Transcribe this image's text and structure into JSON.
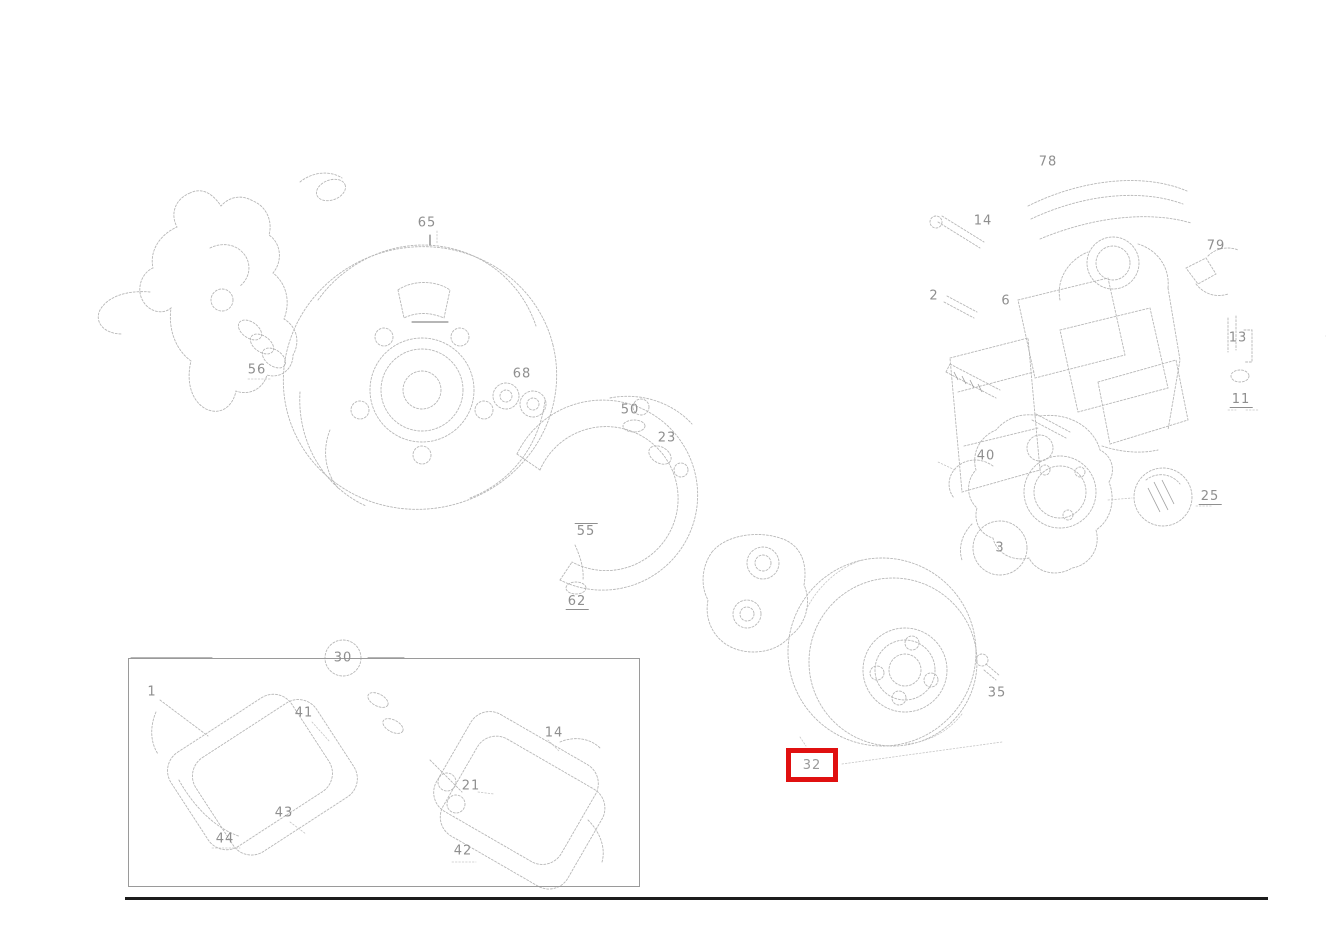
{
  "page": {
    "background": "#ffffff",
    "kind": "exploded-parts-diagram",
    "subject": "brake and wheel hub assembly parts drawing"
  },
  "diagram": {
    "stroke_color": "#b7b7b7",
    "label_color": "#8f8f8f",
    "labels": [
      {
        "id": "label-65",
        "text": "65",
        "x": 427,
        "y": 223
      },
      {
        "id": "label-56",
        "text": "56",
        "x": 257,
        "y": 370
      },
      {
        "id": "label-68",
        "text": "68",
        "x": 522,
        "y": 374
      },
      {
        "id": "label-50",
        "text": "50",
        "x": 630,
        "y": 410
      },
      {
        "id": "label-23",
        "text": "23",
        "x": 667,
        "y": 438
      },
      {
        "id": "label-55",
        "text": "55",
        "x": 586,
        "y": 531,
        "overline": true
      },
      {
        "id": "label-62",
        "text": "62",
        "x": 577,
        "y": 602,
        "underline": true
      },
      {
        "id": "label-78",
        "text": "78",
        "x": 1048,
        "y": 162
      },
      {
        "id": "label-14",
        "text": "14",
        "x": 983,
        "y": 221
      },
      {
        "id": "label-2",
        "text": "2",
        "x": 934,
        "y": 296
      },
      {
        "id": "label-6",
        "text": "6",
        "x": 1006,
        "y": 301
      },
      {
        "id": "label-79",
        "text": "79",
        "x": 1216,
        "y": 246
      },
      {
        "id": "label-13",
        "text": "13",
        "x": 1238,
        "y": 338
      },
      {
        "id": "label-11",
        "text": "11",
        "x": 1241,
        "y": 400,
        "underline": true
      },
      {
        "id": "label-40",
        "text": "40",
        "x": 986,
        "y": 456
      },
      {
        "id": "label-3",
        "text": "3",
        "x": 1000,
        "y": 548
      },
      {
        "id": "label-25",
        "text": "25",
        "x": 1210,
        "y": 497,
        "underline": true
      },
      {
        "id": "label-35",
        "text": "35",
        "x": 997,
        "y": 693
      },
      {
        "id": "label-30",
        "text": "30",
        "x": 343,
        "y": 658
      },
      {
        "id": "label-1",
        "text": "1",
        "x": 152,
        "y": 692
      },
      {
        "id": "label-41",
        "text": "41",
        "x": 304,
        "y": 713
      },
      {
        "id": "label-43",
        "text": "43",
        "x": 284,
        "y": 813
      },
      {
        "id": "label-44",
        "text": "44",
        "x": 225,
        "y": 839
      },
      {
        "id": "label-21",
        "text": "21",
        "x": 471,
        "y": 786
      },
      {
        "id": "label-42",
        "text": "42",
        "x": 463,
        "y": 851
      },
      {
        "id": "label-14b",
        "text": "14",
        "x": 554,
        "y": 733
      }
    ],
    "highlight": {
      "label": "32",
      "x": 786,
      "y": 748,
      "w": 52,
      "h": 34,
      "border_color": "#e01010",
      "border_width": 5
    },
    "inset_box": {
      "x": 128,
      "y": 658,
      "w": 512,
      "h": 229
    },
    "bottom_rule": {
      "x": 125,
      "y": 897,
      "w": 1143,
      "h": 3,
      "color": "#1c1c1c"
    }
  }
}
